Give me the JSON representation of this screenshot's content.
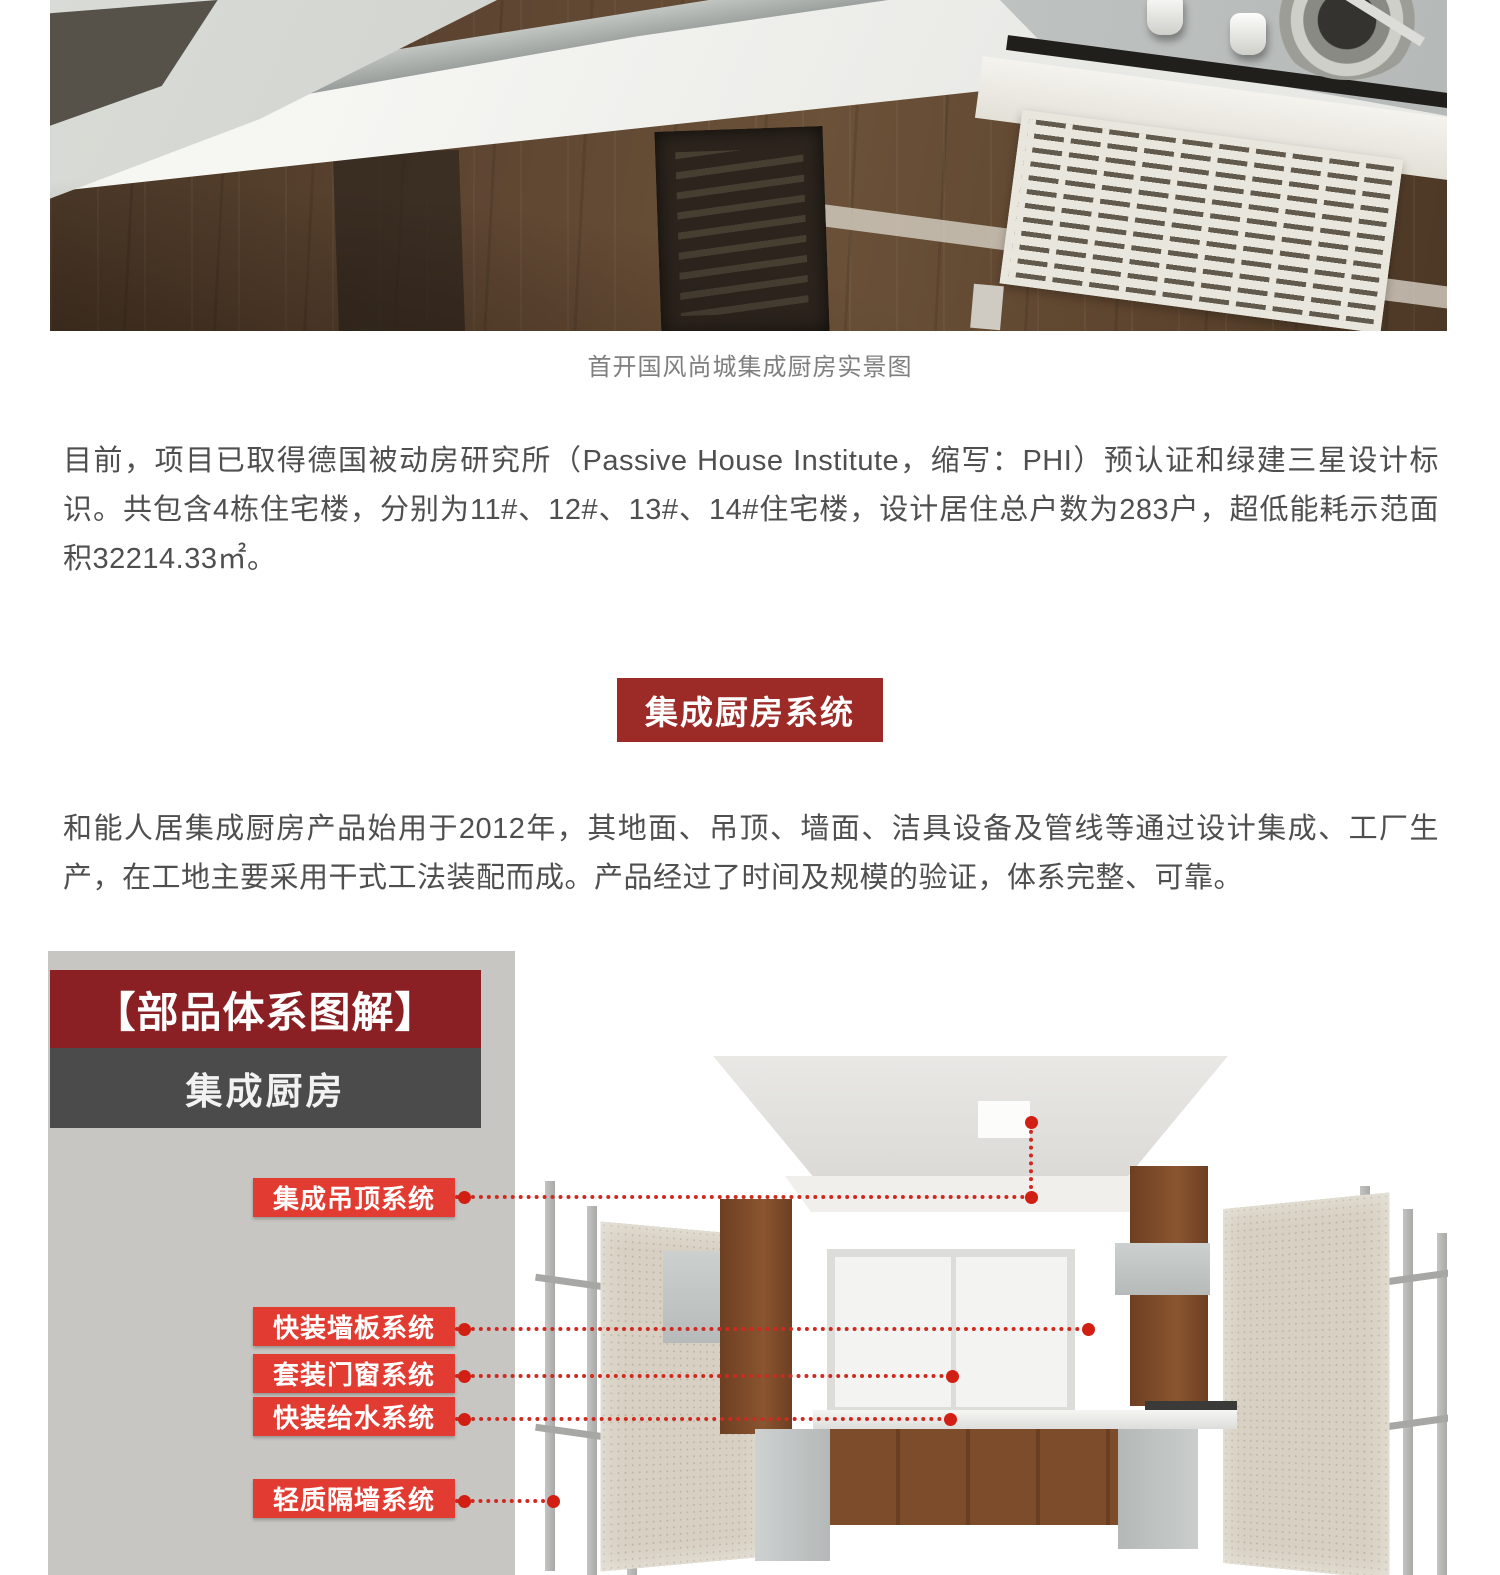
{
  "photo": {
    "caption": "首开国风尚城集成厨房实景图"
  },
  "article": {
    "p1": "目前，项目已取得德国被动房研究所（Passive House Institute，缩写：PHI）预认证和绿建三星设计标识。共包含4栋住宅楼，分别为11#、12#、13#、14#住宅楼，设计居住总户数为283户，超低能耗示范面积32214.33㎡。",
    "p2": "和能人居集成厨房产品始用于2012年，其地面、吊顶、墙面、洁具设备及管线等通过设计集成、工厂生产，在工地主要采用干式工法装配而成。产品经过了时间及规模的验证，体系完整、可靠。"
  },
  "section_banner": {
    "label": "集成厨房系统"
  },
  "infographic": {
    "header_title": "【部品体系图解】",
    "header_subtitle": "集成厨房",
    "labels": [
      "集成吊顶系统",
      "快装墙板系统",
      "套装门窗系统",
      "快装给水系统",
      "轻质隔墙系统"
    ]
  },
  "colors": {
    "banner_red": "#9c2a27",
    "infographic_header_red": "#8a2024",
    "infographic_header_gray": "#4b4b4b",
    "infographic_panel_gray": "#c8c6c3",
    "callout_red": "#e23b32",
    "leader_line_red": "#cf2a20",
    "body_text": "#4f4f4f",
    "caption_text": "#7f7f7f"
  }
}
